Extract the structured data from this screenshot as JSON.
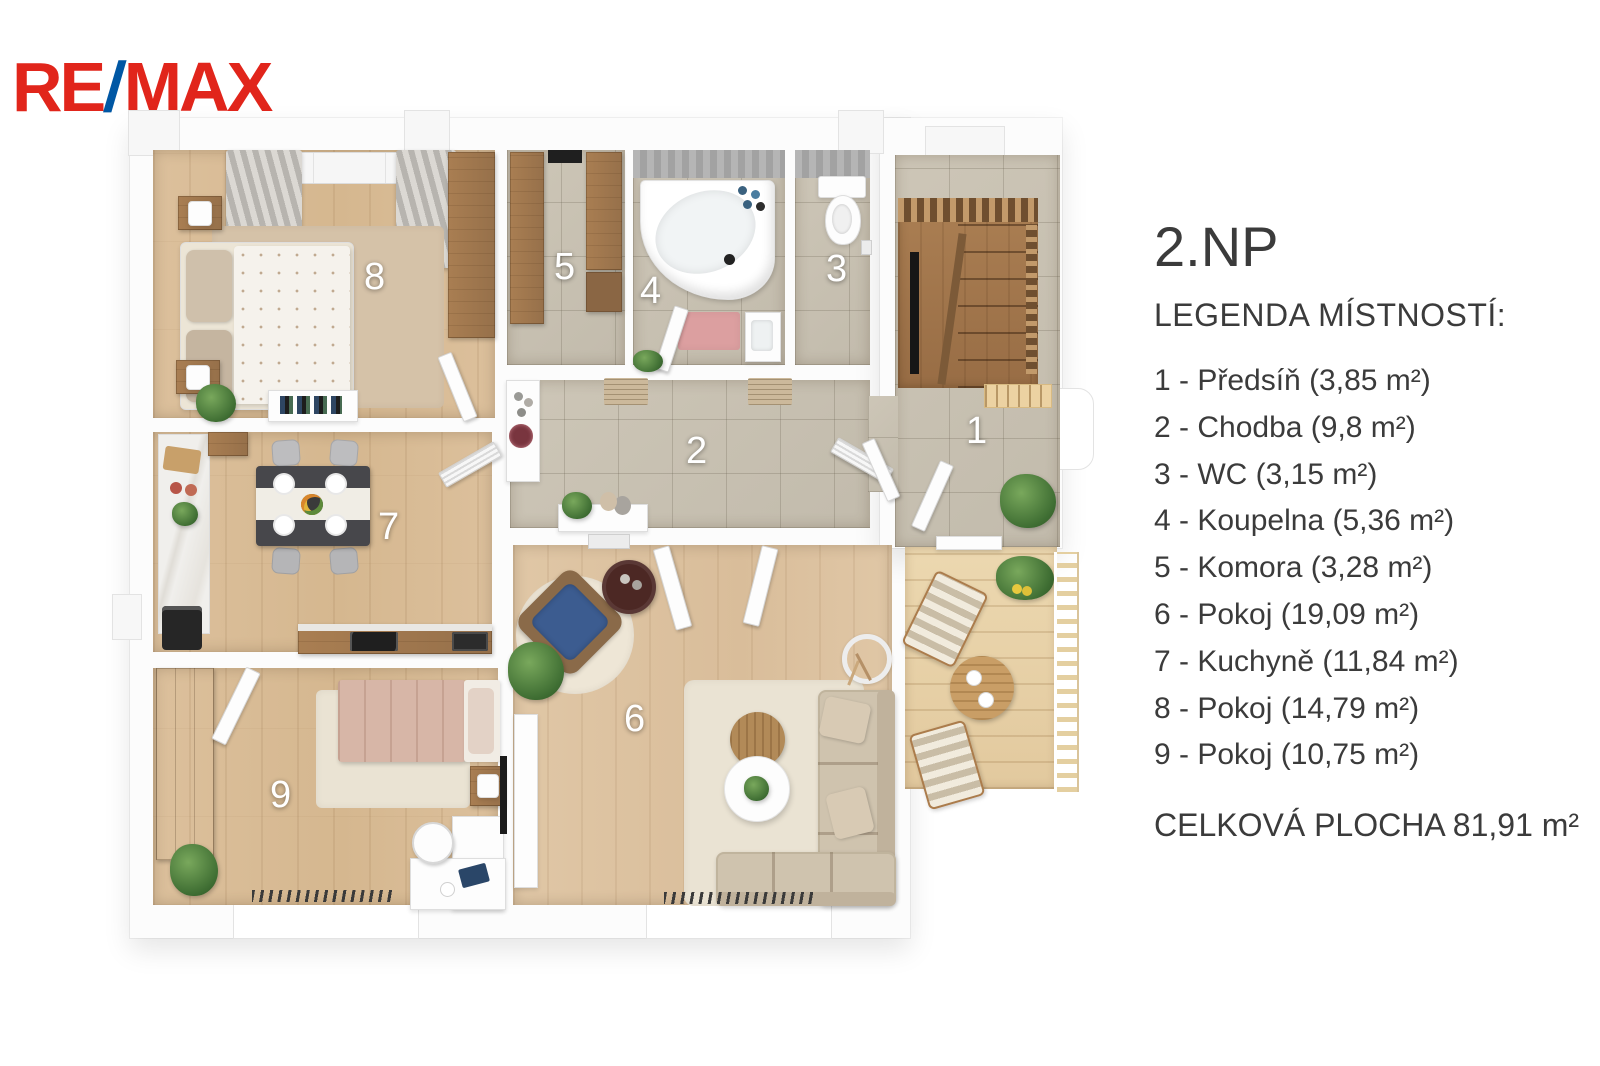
{
  "logo": {
    "re": "RE",
    "slash": "/",
    "max": "MAX"
  },
  "legend": {
    "title": "2.NP",
    "heading": "LEGENDA MÍSTNOSTÍ:",
    "rooms": [
      {
        "num": "1",
        "name": "Předsíň",
        "area": "3,85 m²",
        "label": "1 - Předsíň (3,85 m²)"
      },
      {
        "num": "2",
        "name": "Chodba",
        "area": "9,8 m²",
        "label": "2 - Chodba (9,8 m²)"
      },
      {
        "num": "3",
        "name": "WC",
        "area": "3,15 m²",
        "label": "3 - WC (3,15 m²)"
      },
      {
        "num": "4",
        "name": "Koupelna",
        "area": "5,36 m²",
        "label": "4 - Koupelna (5,36 m²)"
      },
      {
        "num": "5",
        "name": "Komora",
        "area": "3,28 m²",
        "label": "5 - Komora (3,28 m²)"
      },
      {
        "num": "6",
        "name": "Pokoj",
        "area": "19,09 m²",
        "label": "6 - Pokoj (19,09 m²)"
      },
      {
        "num": "7",
        "name": "Kuchyně",
        "area": "11,84 m²",
        "label": "7 - Kuchyně (11,84 m²)"
      },
      {
        "num": "8",
        "name": "Pokoj",
        "area": "14,79 m²",
        "label": "8 - Pokoj (14,79 m²)"
      },
      {
        "num": "9",
        "name": "Pokoj",
        "area": "10,75 m²",
        "label": "9 - Pokoj (10,75 m²)"
      }
    ],
    "total": "CELKOVÁ PLOCHA 81,91 m²"
  },
  "plan": {
    "room_numbers": [
      "1",
      "2",
      "3",
      "4",
      "5",
      "6",
      "7",
      "8",
      "9"
    ]
  },
  "colors": {
    "remax_red": "#e1251b",
    "remax_blue": "#0057a4",
    "text": "#3b3b3b",
    "wood_floor": "#d9bd9b",
    "tile_floor": "#c8c1b2",
    "deck": "#e7d2ab",
    "stairs": "#a57b50",
    "room_label": "#ffffff"
  }
}
